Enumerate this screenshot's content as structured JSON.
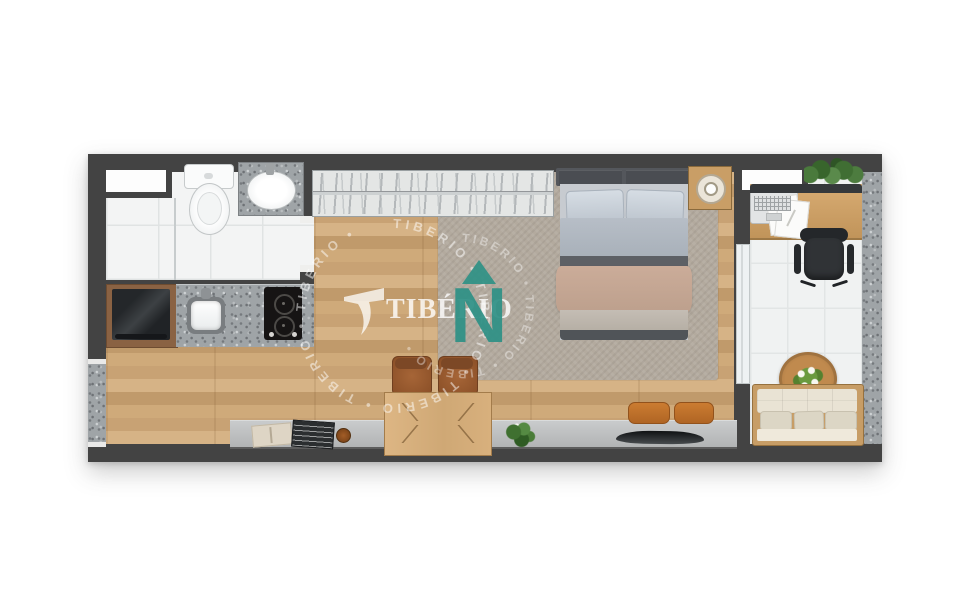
{
  "image": {
    "kind": "apartment-floor-plan-render",
    "width": 971,
    "height": 609
  },
  "watermark": {
    "wordmark": "TIBÉRIO",
    "north_letter": "N",
    "ring_text": "TIBERIO  •  TIBERIO  •  TIBERIO  •  TIBERIO  •  TIBERIO  •  ",
    "ring_text_inner": "TIBERIO  •  TIBERIO  •  TIBERIO  •  ",
    "colors": {
      "north_teal": "#2f9186",
      "ring_white": "rgba(255,255,255,0.5)",
      "wordmark_white": "rgba(255,255,255,0.8)"
    }
  },
  "palette": {
    "background": "#ffffff",
    "wall": "#434343",
    "wood_floor": "#cda97a",
    "rug": "#b3aa9e",
    "bathroom_tile": "#f3f4f4",
    "balcony_tile": "#f0f2f2",
    "granite": "#9fa4a7",
    "furniture_wood": "#d0a569",
    "sofa_cream": "#e9e3d4",
    "chair_brown": "#9a5d31",
    "cushion_orange": "#c4742d",
    "plant_green": "#4a7a3c",
    "sideboard_gray": "#bfc1c2"
  },
  "furniture": {
    "items": [
      "wardrobe-closet",
      "double-bed",
      "nightstand-with-lamp",
      "area-rug",
      "dining-table",
      "dining-chairs",
      "tv-on-sideboard",
      "floor-cushions",
      "sideboard-ledge",
      "book",
      "magazine",
      "decor-knob",
      "potted-plant",
      "refrigerator",
      "kitchen-sink",
      "cooktop",
      "toilet",
      "bathroom-sink",
      "shower-screen",
      "desk",
      "laptop",
      "papers",
      "office-chair",
      "hanging-plants",
      "sofa",
      "coffee-table-with-flowers"
    ]
  }
}
